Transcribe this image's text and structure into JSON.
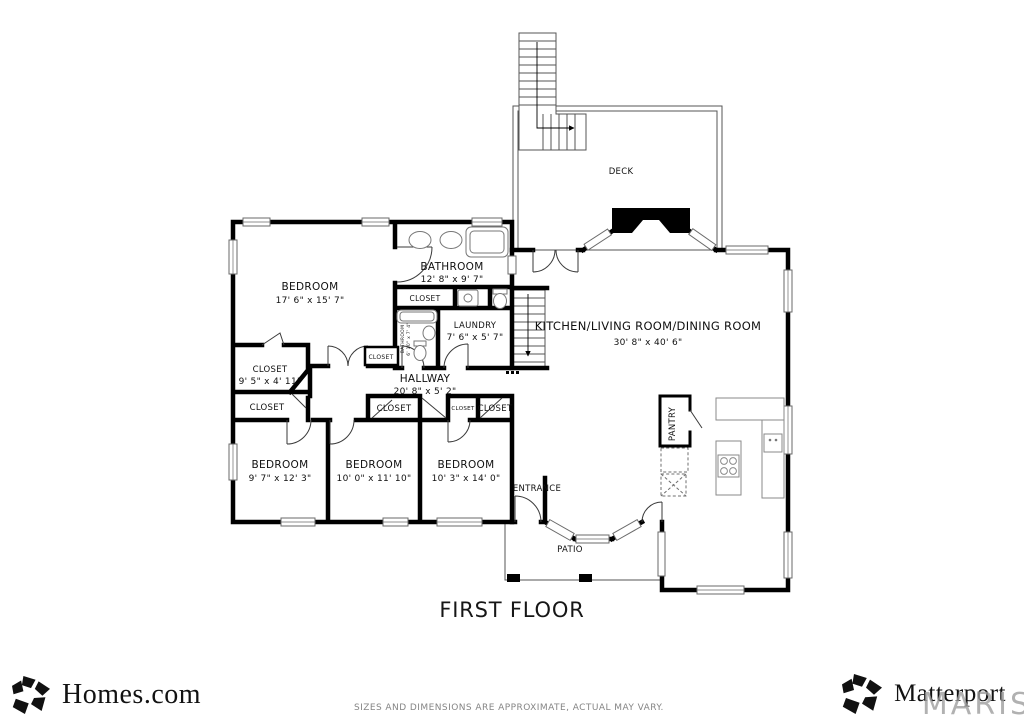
{
  "colors": {
    "wall": "#000000",
    "thin_line": "#555555",
    "label": "#101010",
    "watermark": "#9e9e9e",
    "disclaimer": "#858585"
  },
  "plan": {
    "floor_title": "FIRST FLOOR",
    "closet_label": "CLOSET",
    "rooms": {
      "bedroom_main": {
        "name": "BEDROOM",
        "dims": "17' 6\" x 15' 7\""
      },
      "bathroom_main": {
        "name": "BATHROOM",
        "dims": "12' 8\" x 9' 7\""
      },
      "bathroom_small": {
        "name": "BATHROOM",
        "dims": "6' 10\" x 7' 4\""
      },
      "laundry": {
        "name": "LAUNDRY",
        "dims": "7' 6\" x 5' 7\""
      },
      "closet_main": {
        "name": "CLOSET",
        "dims": "9' 5\" x 4' 11\""
      },
      "hallway": {
        "name": "HALLWAY",
        "dims": "20' 8\" x 5' 2\""
      },
      "bedroom_sw": {
        "name": "BEDROOM",
        "dims": "9' 7\" x 12' 3\""
      },
      "bedroom_s": {
        "name": "BEDROOM",
        "dims": "10' 0\" x 11' 10\""
      },
      "bedroom_se": {
        "name": "BEDROOM",
        "dims": "10' 3\" x 14' 0\""
      },
      "great_room": {
        "name": "KITCHEN/LIVING ROOM/DINING ROOM",
        "dims": "30' 8\" x 40' 6\""
      },
      "deck": {
        "name": "DECK"
      },
      "pantry": {
        "name": "PANTRY"
      },
      "entrance": {
        "name": "ENTRANCE"
      },
      "patio": {
        "name": "PATIO"
      }
    }
  },
  "footer": {
    "homes_logo_text": "Homes.com",
    "matterport_logo_text": "Matterport",
    "disclaimer": "SIZES AND DIMENSIONS ARE APPROXIMATE, ACTUAL MAY VARY.",
    "watermark": "MARIS"
  }
}
